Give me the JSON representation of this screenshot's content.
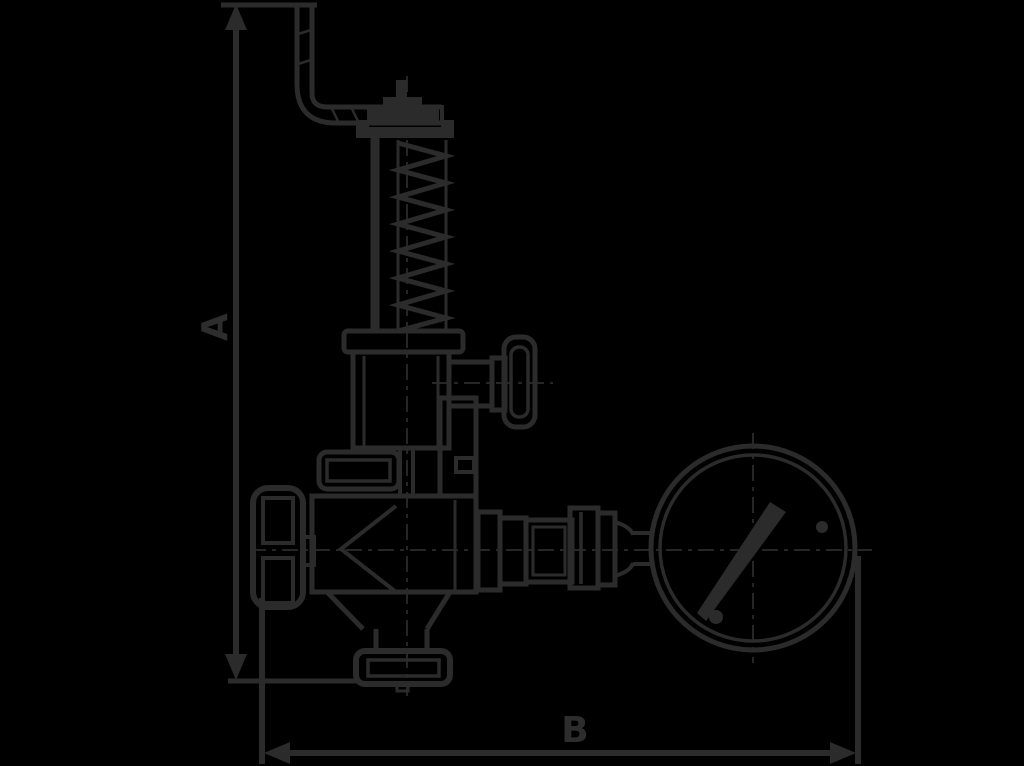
{
  "diagram": {
    "type": "technical-line-drawing",
    "subject": "safety-relief-valve-with-pressure-gauge",
    "background_color": "#000000",
    "line_color": "#2b2b2b",
    "label_color": "#2d2d2d",
    "dimensions": {
      "vertical": {
        "label": "A"
      },
      "horizontal": {
        "label": "B"
      }
    },
    "components": [
      "lever-arm",
      "lever-pivot-cap",
      "yoke-rod",
      "spring-column",
      "bonnet-cap",
      "bonnet-body",
      "adjustment-knob",
      "union-nut",
      "valve-body",
      "handwheel",
      "outlet-flange",
      "pipe-fittings",
      "pressure-gauge",
      "gauge-needle"
    ]
  }
}
